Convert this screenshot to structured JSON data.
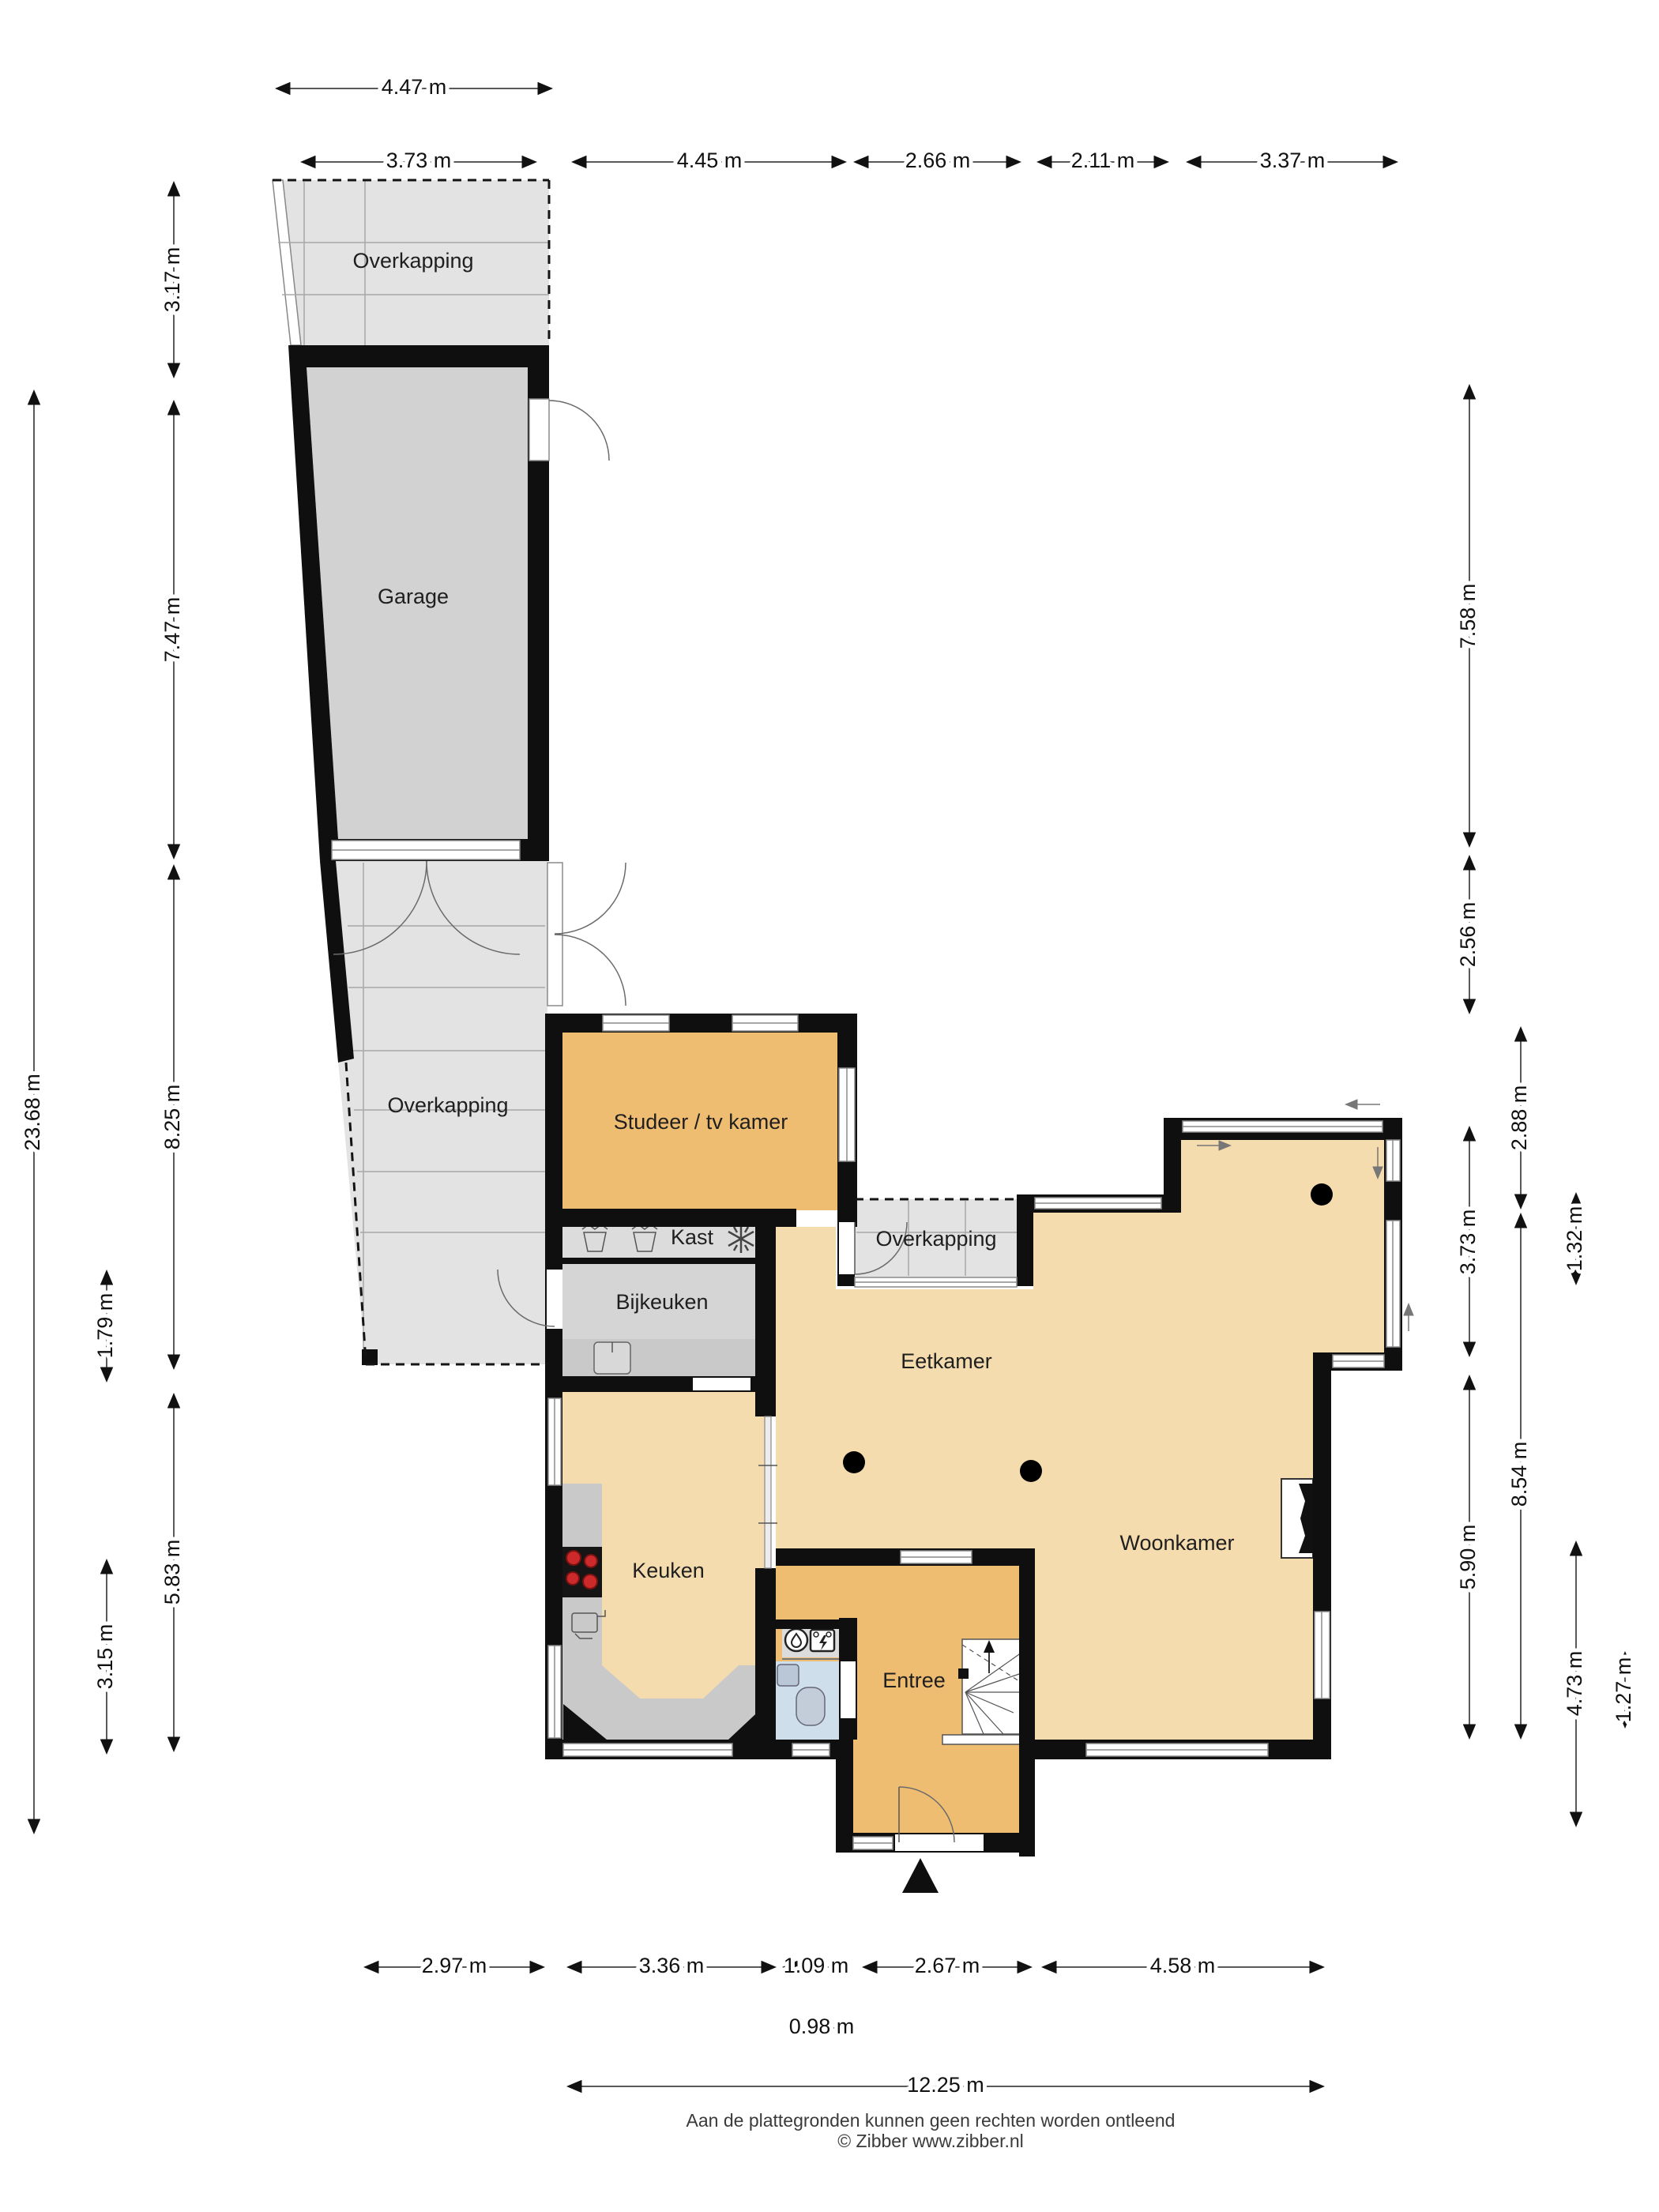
{
  "rooms": {
    "overkapping_top": "Overkapping",
    "garage": "Garage",
    "overkapping_mid": "Overkapping",
    "studeer": "Studeer / tv kamer",
    "kast": "Kast",
    "bijkeuken": "Bijkeuken",
    "overkapping_small": "Overkapping",
    "eetkamer": "Eetkamer",
    "keuken": "Keuken",
    "woonkamer": "Woonkamer",
    "entree": "Entree"
  },
  "dimensions": {
    "top_row1": [
      {
        "label": "4.47 m"
      }
    ],
    "top_row2": [
      {
        "label": "3.73 m"
      },
      {
        "label": "4.45 m"
      },
      {
        "label": "2.66 m"
      },
      {
        "label": "2.11 m"
      },
      {
        "label": "3.37 m"
      }
    ],
    "left_outer": [
      {
        "label": "23.68 m"
      }
    ],
    "left_mid": [
      {
        "label": "3.17 m"
      },
      {
        "label": "7.47 m"
      },
      {
        "label": "8.25 m"
      },
      {
        "label": "5.83 m"
      }
    ],
    "left_inner": [
      {
        "label": "1.79 m"
      },
      {
        "label": "3.15 m"
      }
    ],
    "right_col1": [
      {
        "label": "7.58 m"
      },
      {
        "label": "2.56 m"
      },
      {
        "label": "3.73 m"
      },
      {
        "label": "5.90 m"
      }
    ],
    "right_col2": [
      {
        "label": "2.88 m"
      },
      {
        "label": "8.54 m"
      }
    ],
    "right_col3": [
      {
        "label": "1.32 m"
      },
      {
        "label": "4.73 m"
      }
    ],
    "right_col4": [
      {
        "label": "1.27 m"
      }
    ],
    "bottom_row1": [
      {
        "label": "2.97 m"
      },
      {
        "label": "3.36 m"
      },
      {
        "label": "1.09 m"
      },
      {
        "label": "2.67 m"
      },
      {
        "label": "4.58 m"
      }
    ],
    "bottom_row2": [
      {
        "label": "0.98 m"
      }
    ],
    "bottom_row3": [
      {
        "label": "12.25 m"
      }
    ]
  },
  "footer": {
    "line1": "Aan de plattegronden kunnen geen rechten worden ontleend",
    "line2": "© Zibber www.zibber.nl"
  },
  "colors": {
    "wall": "#0f0f0f",
    "floor_living": "#f5dcae",
    "floor_accent": "#efbd72",
    "floor_garage": "#d2d2d2",
    "floor_outdoor": "#e3e3e3",
    "floor_utility": "#d5d5d5",
    "floor_closet": "#dcdcdc",
    "floor_toilet": "#cfdeeb",
    "counter": "#c9c9c9",
    "burner": "#cc2a2a"
  }
}
